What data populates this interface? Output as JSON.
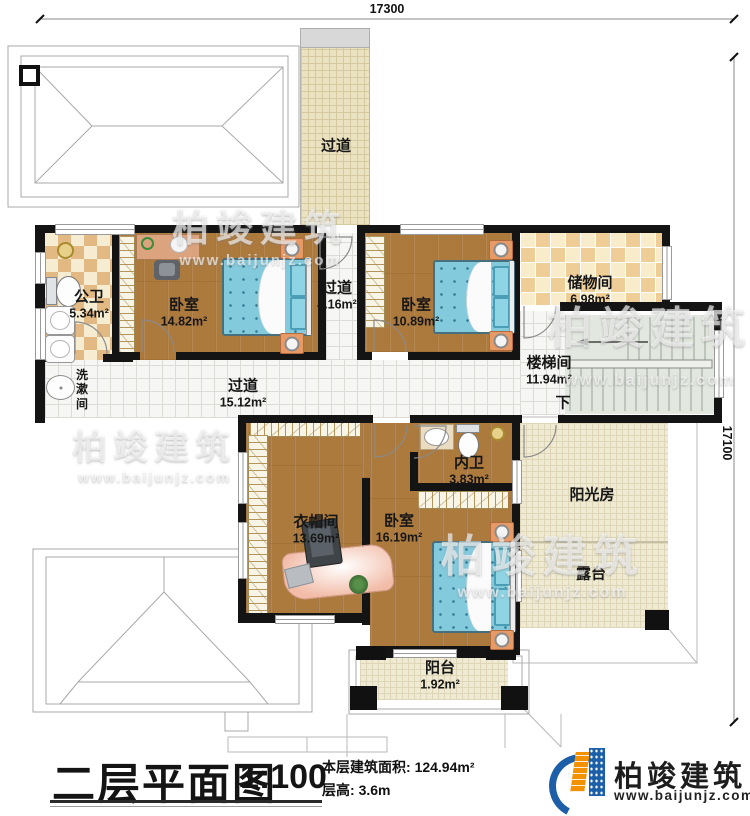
{
  "dimensions": {
    "top": "17300",
    "right": "17100"
  },
  "rooms": {
    "hall_top": {
      "name": "过道"
    },
    "public_bath": {
      "name": "公卫",
      "area": "5.34m²"
    },
    "bedroom1": {
      "name": "卧室",
      "area": "14.82m²"
    },
    "hall_mid": {
      "name": "过道",
      "area": "4.16m²"
    },
    "bedroom2": {
      "name": "卧室",
      "area": "10.89m²"
    },
    "storage": {
      "name": "储物间",
      "area": "6.98m²"
    },
    "stairwell": {
      "name": "楼梯间",
      "area": "11.94m²",
      "down_label": "下"
    },
    "washroom": {
      "name": "洗漱间"
    },
    "hall_main": {
      "name": "过道",
      "area": "15.12m²"
    },
    "inner_bath": {
      "name": "内卫",
      "area": "3.83m²"
    },
    "cloakroom": {
      "name": "衣帽间",
      "area": "13.69m²"
    },
    "bedroom3": {
      "name": "卧室",
      "area": "16.19m²"
    },
    "sunroom": {
      "name": "阳光房"
    },
    "terrace": {
      "name": "露台"
    },
    "balcony": {
      "name": "阳台",
      "area": "1.92m²"
    }
  },
  "title_block": {
    "title": "二层平面图",
    "scale": "1:100",
    "area_label": "本层建筑面积:",
    "area_value": "124.94m²",
    "height_label": "层高:",
    "height_value": "3.6m"
  },
  "brand": {
    "name": "柏竣建筑",
    "website": "www.baijunjz.com"
  },
  "watermark": {
    "name": "柏竣建筑",
    "website": "www.baijunjz.com"
  }
}
